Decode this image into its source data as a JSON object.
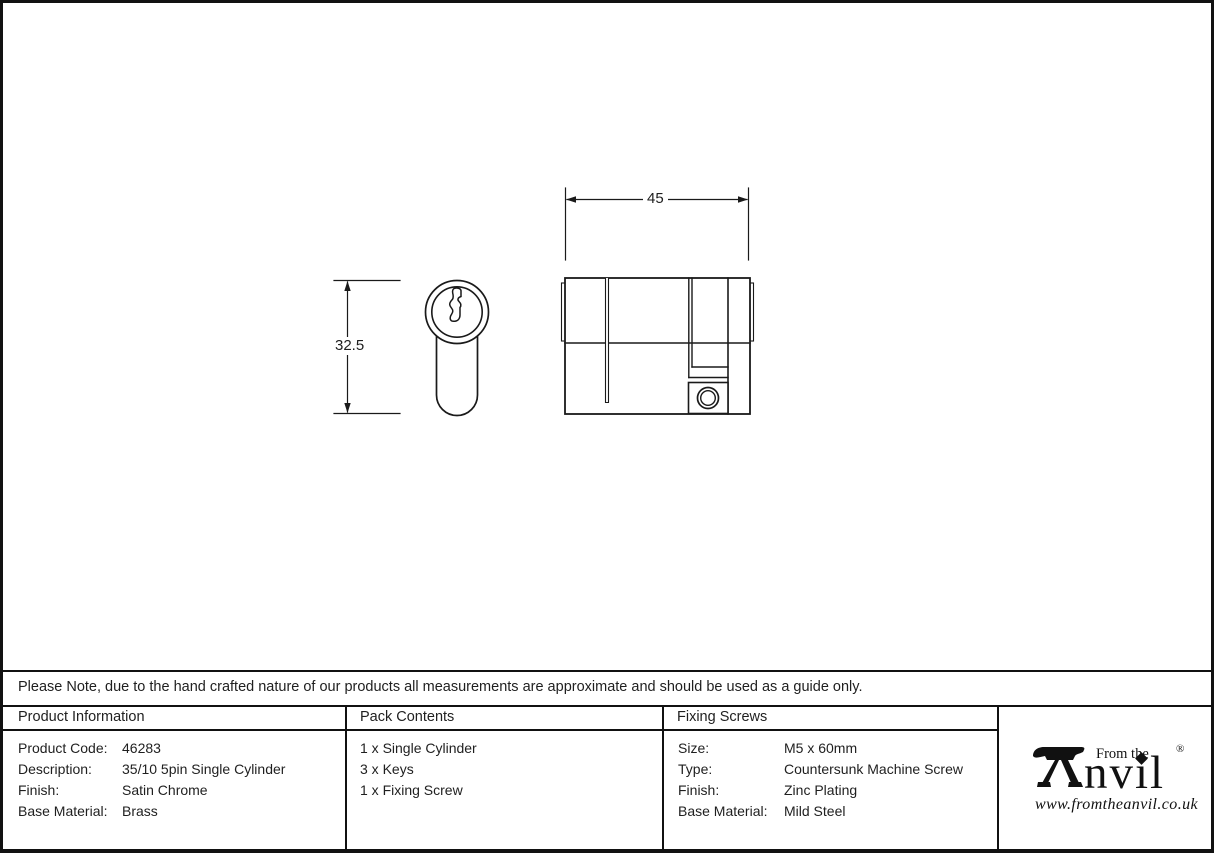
{
  "document": {
    "note": "Please Note, due to the hand crafted nature of our products all measurements are approximate and should be used as a guide only."
  },
  "drawing": {
    "width_dim": "45",
    "height_dim": "32.5"
  },
  "table": {
    "product_information": {
      "header": "Product Information",
      "rows": [
        {
          "label": "Product Code:",
          "value": "46283"
        },
        {
          "label": "Description:",
          "value": "35/10 5pin Single Cylinder"
        },
        {
          "label": "Finish:",
          "value": "Satin Chrome"
        },
        {
          "label": "Base Material:",
          "value": "Brass"
        }
      ]
    },
    "pack_contents": {
      "header": "Pack Contents",
      "items": [
        "1 x Single Cylinder",
        "3 x Keys",
        "1 x Fixing Screw"
      ]
    },
    "fixing_screws": {
      "header": "Fixing Screws",
      "rows": [
        {
          "label": "Size:",
          "value": "M5 x 60mm"
        },
        {
          "label": "Type:",
          "value": "Countersunk Machine Screw"
        },
        {
          "label": "Finish:",
          "value": "Zinc Plating"
        },
        {
          "label": "Base Material:",
          "value": "Mild Steel"
        }
      ]
    }
  },
  "logo": {
    "brand": "Anvil",
    "brand_suffix_display": "nvıl",
    "tagline": "From the",
    "registered_mark": "®",
    "website": "www.fromtheanvil.co.uk"
  }
}
